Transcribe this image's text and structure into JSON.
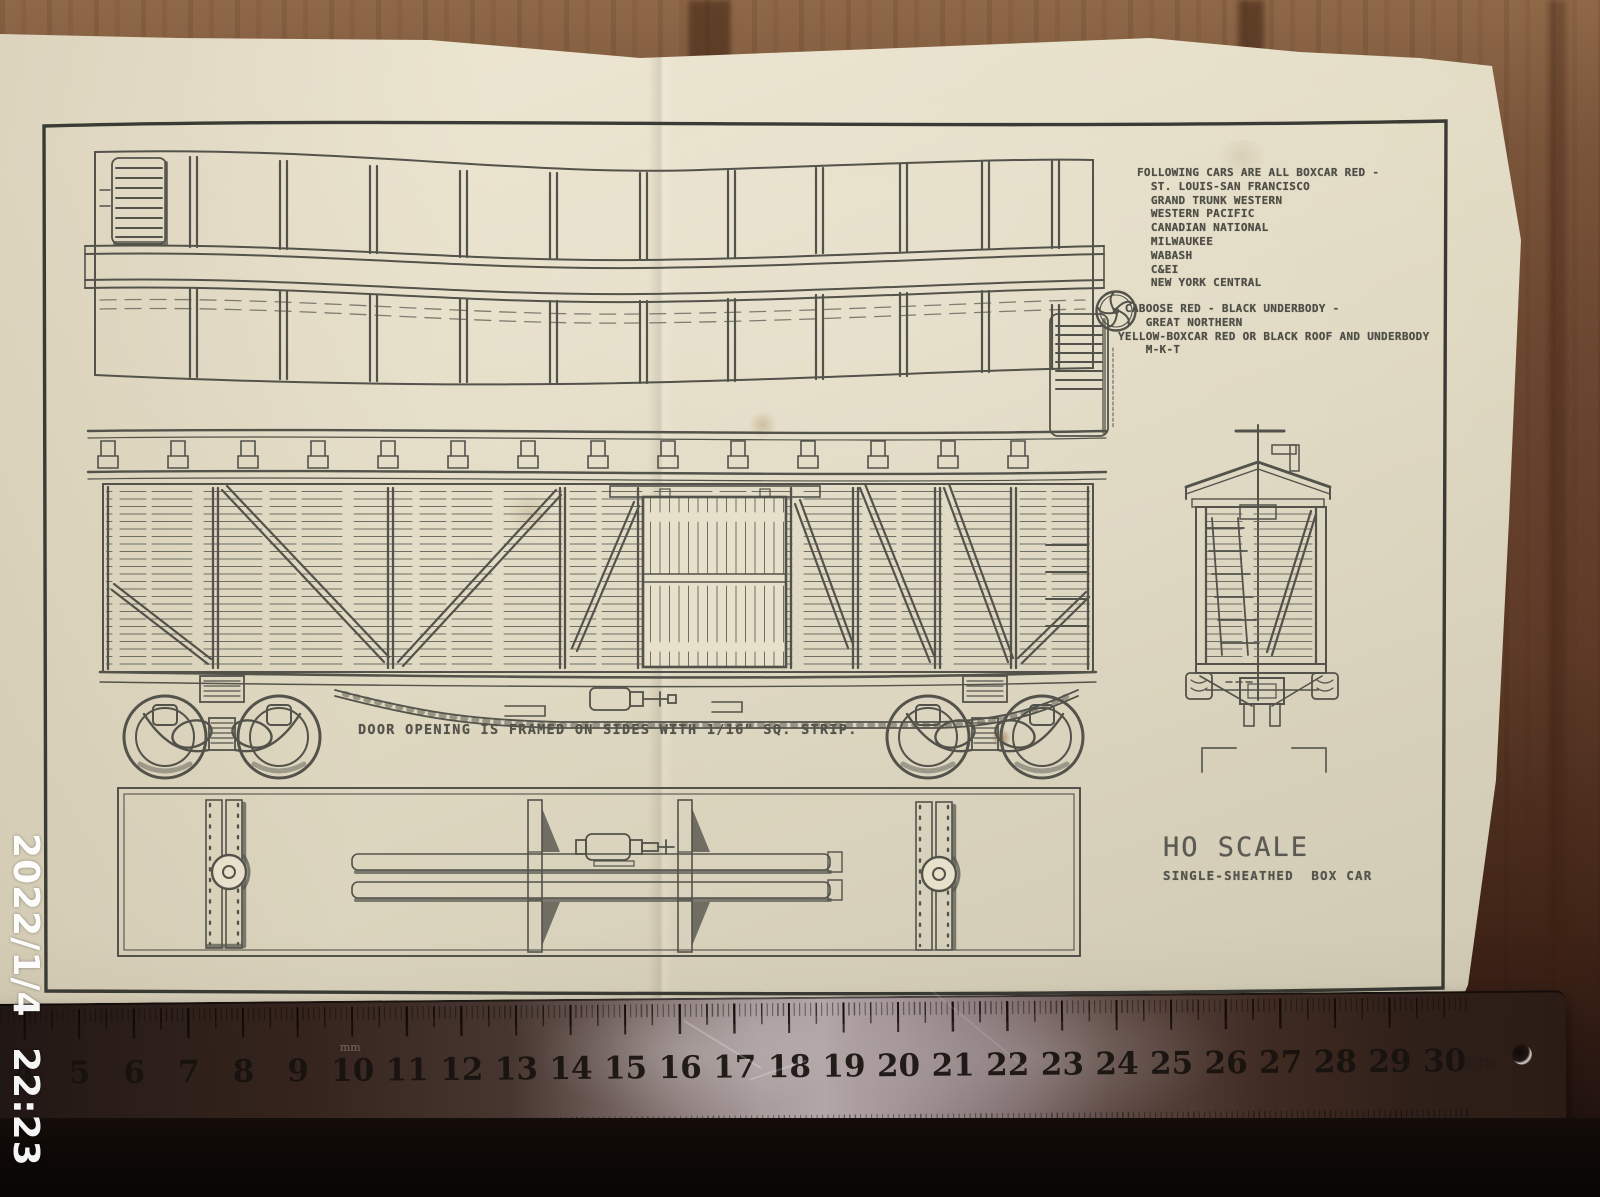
{
  "photo": {
    "timestamp": "2022/1/4 22:23"
  },
  "plan": {
    "notes_block1": {
      "lines": [
        "FOLLOWING CARS ARE ALL BOXCAR RED -",
        "  ST. LOUIS-SAN FRANCISCO",
        "  GRAND TRUNK WESTERN",
        "  WESTERN PACIFIC",
        "  CANADIAN NATIONAL",
        "  MILWAUKEE",
        "  WABASH",
        "  C&EI",
        "  NEW YORK CENTRAL"
      ]
    },
    "notes_block2": {
      "lines": [
        " CABOOSE RED - BLACK UNDERBODY -",
        "    GREAT NORTHERN",
        "YELLOW-BOXCAR RED OR BLACK ROOF AND UNDERBODY",
        "    M-K-T"
      ]
    },
    "caption": "DOOR OPENING IS FRAMED ON SIDES WITH 1/16\" SQ. STRIP.",
    "title": "HO SCALE",
    "subtitle": "SINGLE-SHEATHED  BOX CAR"
  },
  "ruler": {
    "numbers": [
      4,
      5,
      6,
      7,
      8,
      9,
      10,
      11,
      12,
      13,
      14,
      15,
      16,
      17,
      18,
      19,
      20,
      21,
      22,
      23,
      24,
      25,
      26,
      27,
      28,
      29,
      30
    ],
    "unit": "cm",
    "mm_label": "mm"
  },
  "colors": {
    "paper": "#e2dbc4",
    "ink": "#4e4e46",
    "wood": "#6b4630",
    "ruler_metal": "#a99c9d",
    "timestamp": "#ffffff"
  }
}
